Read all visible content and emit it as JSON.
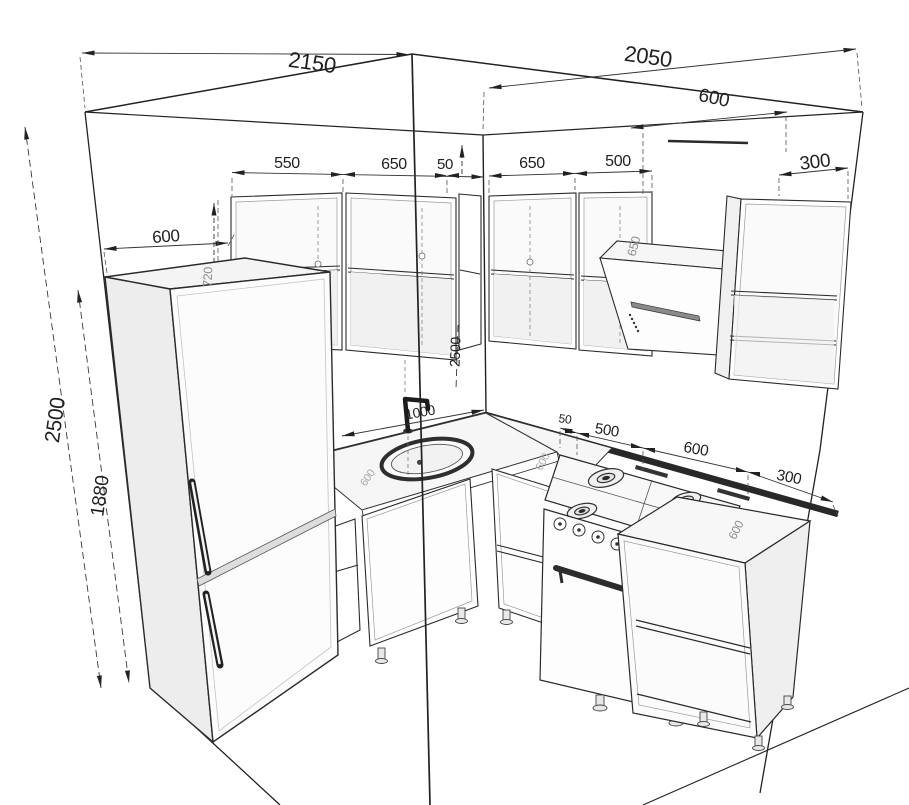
{
  "drawing": {
    "kind": "kitchen-corner-dimension-drawing",
    "dims": {
      "wall_left": "2150",
      "wall_right": "2050",
      "hood_width": "600",
      "left_upper": [
        "550",
        "650",
        "50"
      ],
      "right_upper": [
        "650",
        "500"
      ],
      "tall_cabinet_width": "300",
      "fridge_width": "600",
      "ceiling_height": "2500",
      "fridge_height": "1880",
      "upper_cabinet_height": "720",
      "corner_height": "2500",
      "hood_cabinet_height": "650",
      "faucet_offset": "1000",
      "base_right": [
        "50",
        "500",
        "600",
        "300"
      ],
      "counter_depth": "600",
      "end_unit_depth": "600"
    },
    "colors": {
      "line": "#1f1f1f",
      "dim_text": "#1f1f1f",
      "faint_text": "#8f8f8f",
      "counter_edge": "#282828",
      "fill_light": "#f2f2f2"
    }
  }
}
